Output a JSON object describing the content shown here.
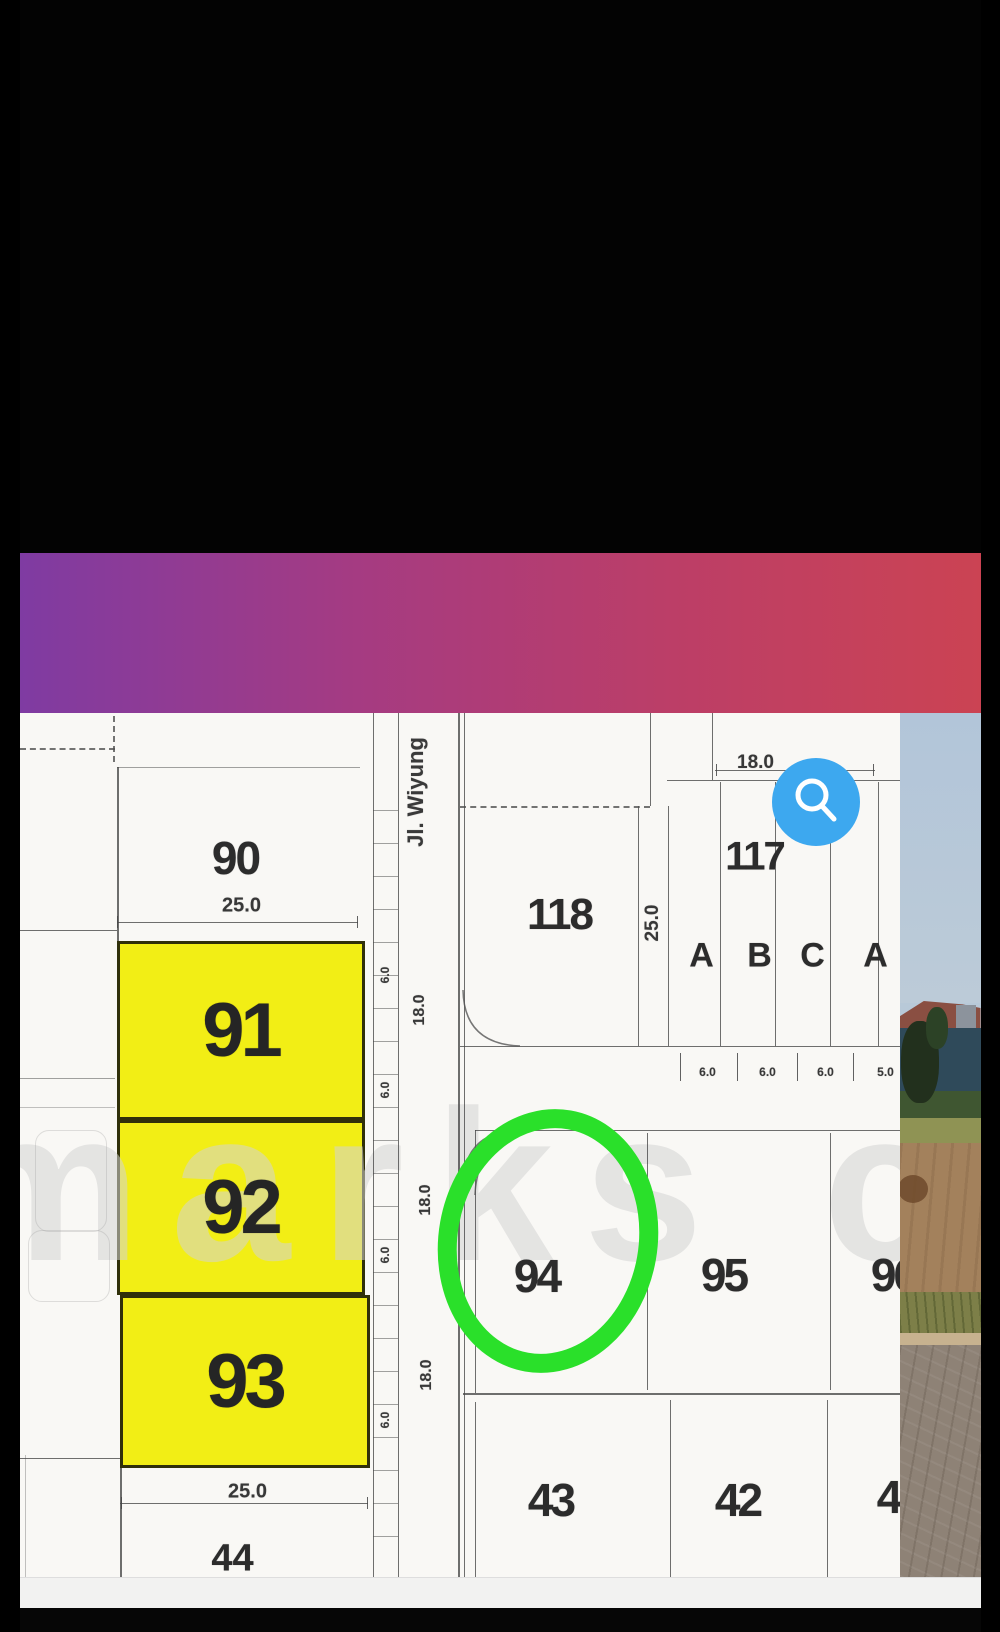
{
  "nav": {
    "items": [
      {
        "label": "me",
        "caret": false
      },
      {
        "label": "About Us",
        "caret": true
      },
      {
        "label": "Highlights",
        "caret": true
      },
      {
        "label": "Property Search",
        "caret": true
      },
      {
        "label": "Article",
        "caret": false
      },
      {
        "label": "Age",
        "caret": false
      }
    ],
    "caret_color": "#5f9fe0",
    "gradient": [
      "#7f3ba2",
      "#a53b82",
      "#bc3e67",
      "#cb4353"
    ]
  },
  "map": {
    "road_name": "Jl. Wiyung",
    "watermark": "marks co",
    "plots": {
      "p90": "90",
      "p91": "91",
      "p92": "92",
      "p93": "93",
      "p94": "94",
      "p95": "95",
      "p96": "96",
      "p117": "117",
      "p118": "118",
      "p42": "42",
      "p43": "43",
      "p44": "44",
      "p4x": "4"
    },
    "units": {
      "a1": "A",
      "b1": "B",
      "c1": "C",
      "a2": "A"
    },
    "dims": {
      "d18": "18.0",
      "d25": "25.0",
      "d6": "6.0",
      "d5": "5.0"
    },
    "highlight_fill": "#f2ee15",
    "annotation_green": "#2ae02a",
    "zoom_button_blue": "#3da8ef"
  }
}
